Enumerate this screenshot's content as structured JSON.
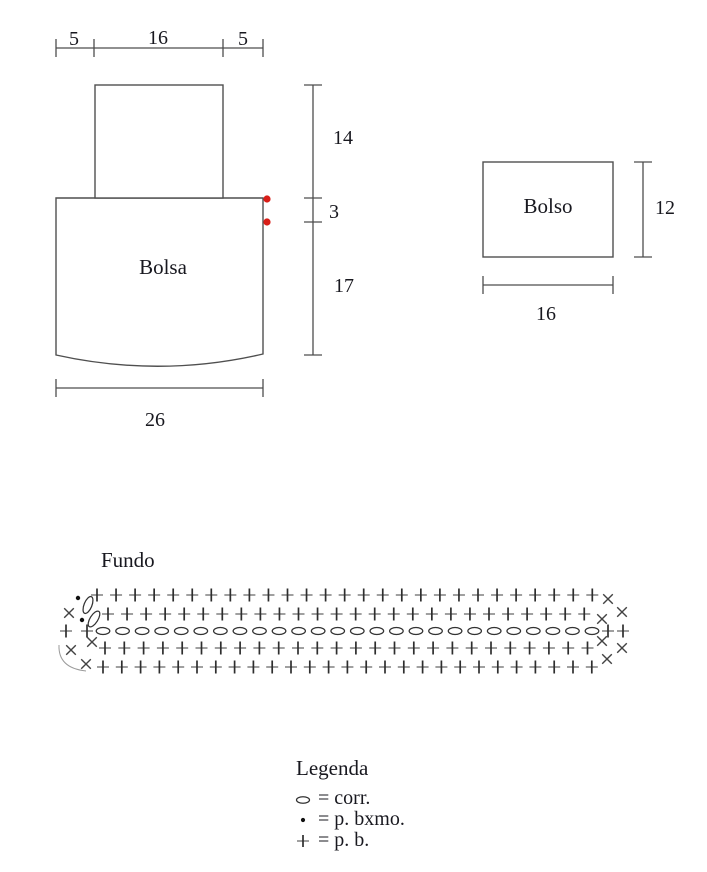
{
  "colors": {
    "background": "#ffffff",
    "line": "#4d4d4d",
    "text": "#18181f",
    "red_marker": "#d91e18",
    "plus_horizontal": "#8f8f8f",
    "plus_vertical": "#2e2e2e",
    "cross": "#424242",
    "chain_outline": "#333333"
  },
  "bag": {
    "label": "Bolsa",
    "dim_top_left": "5",
    "dim_top_mid": "16",
    "dim_top_right": "5",
    "dim_flap_height": "14",
    "dim_gap": "3",
    "dim_body_height": "17",
    "dim_bottom_width": "26"
  },
  "pocket": {
    "label": "Bolso",
    "dim_height": "12",
    "dim_width": "16"
  },
  "fundo": {
    "title": "Fundo"
  },
  "chart_data": {
    "type": "crochet-stitch-chart",
    "title": "Fundo",
    "rows": [
      {
        "symbol": "sc",
        "y": 595,
        "x_start": 97,
        "count": 27,
        "spacing": 19.05
      },
      {
        "symbol": "sc",
        "y": 614,
        "x_start": 108,
        "count": 26,
        "spacing": 19.05
      },
      {
        "symbol": "chain",
        "y": 631,
        "x_start": 103,
        "count": 26,
        "spacing": 19.56
      },
      {
        "symbol": "sc",
        "y": 648,
        "x_start": 105,
        "count": 26,
        "spacing": 19.3
      },
      {
        "symbol": "sc",
        "y": 667,
        "x_start": 103,
        "count": 27,
        "spacing": 18.8
      }
    ],
    "left_end": {
      "sc": [
        [
          66,
          631
        ],
        [
          87,
          631
        ]
      ],
      "inc": [
        [
          69,
          613
        ],
        [
          92,
          642
        ],
        [
          71,
          650
        ],
        [
          86,
          664
        ]
      ],
      "slip": [
        [
          78,
          598
        ],
        [
          82,
          620
        ]
      ],
      "turn_chains": [
        {
          "x": 88,
          "y": 605,
          "angle": 22
        },
        {
          "x": 94,
          "y": 619,
          "angle": 32
        }
      ],
      "arc": "M59,645 Q58,668 86,671"
    },
    "right_end": {
      "sc": [
        [
          608,
          631
        ],
        [
          623,
          631
        ]
      ],
      "inc": [
        [
          608,
          599
        ],
        [
          622,
          612
        ],
        [
          602,
          619
        ],
        [
          602,
          641
        ],
        [
          622,
          648
        ],
        [
          607,
          659
        ]
      ]
    }
  },
  "legend": {
    "title": "Legenda",
    "items": [
      {
        "symbol": "chain",
        "label": "= corr."
      },
      {
        "symbol": "slip",
        "label": "= p. bxmo."
      },
      {
        "symbol": "sc",
        "label": "= p. b."
      }
    ]
  }
}
